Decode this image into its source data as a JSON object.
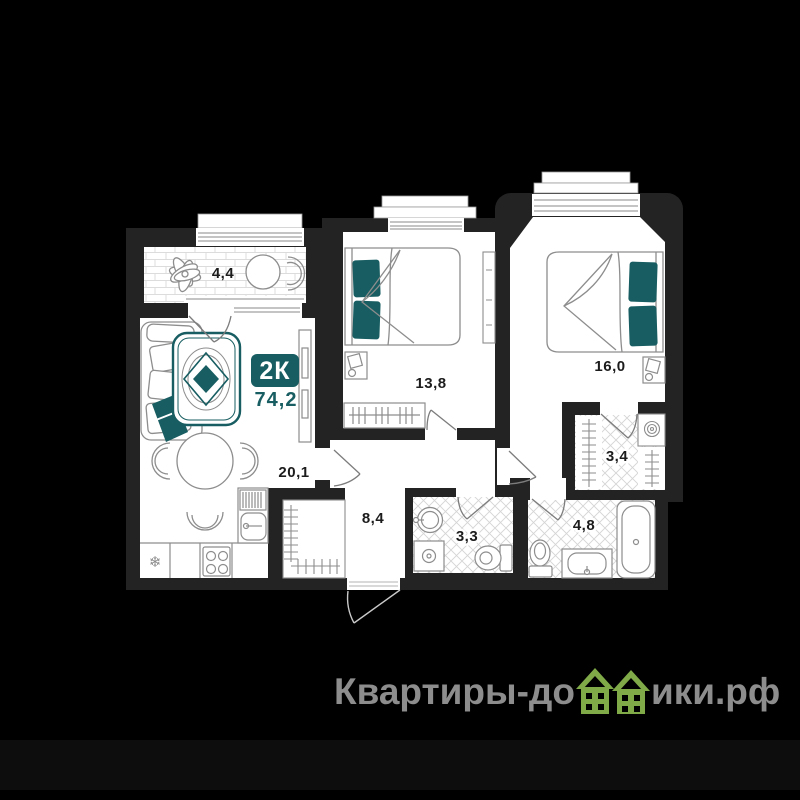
{
  "plan": {
    "type_badge": "2К",
    "total_area": "74,2",
    "rooms": [
      {
        "name": "balcony",
        "area": "4,4"
      },
      {
        "name": "bedroom-1",
        "area": "13,8"
      },
      {
        "name": "bedroom-2",
        "area": "16,0"
      },
      {
        "name": "living-kitchen",
        "area": "20,1"
      },
      {
        "name": "hallway",
        "area": "8,4"
      },
      {
        "name": "bathroom-1",
        "area": "3,3"
      },
      {
        "name": "wardrobe-room",
        "area": "3,4"
      },
      {
        "name": "bathroom-2",
        "area": "4,8"
      }
    ],
    "fridge_glyph": "❄",
    "colors": {
      "accent_teal": "#175d61",
      "wall": "#232324",
      "floor": "#ffffff",
      "background": "#000000",
      "tile_line": "#d6d6d6",
      "furniture_line": "#8d8d8d"
    }
  },
  "watermark": {
    "full_text": "Квартиры-домики.рф",
    "text_left": "Квартиры-до",
    "text_right": "ики.рф",
    "text_color": "#8d8d8d",
    "house_color": "#7faa47"
  }
}
